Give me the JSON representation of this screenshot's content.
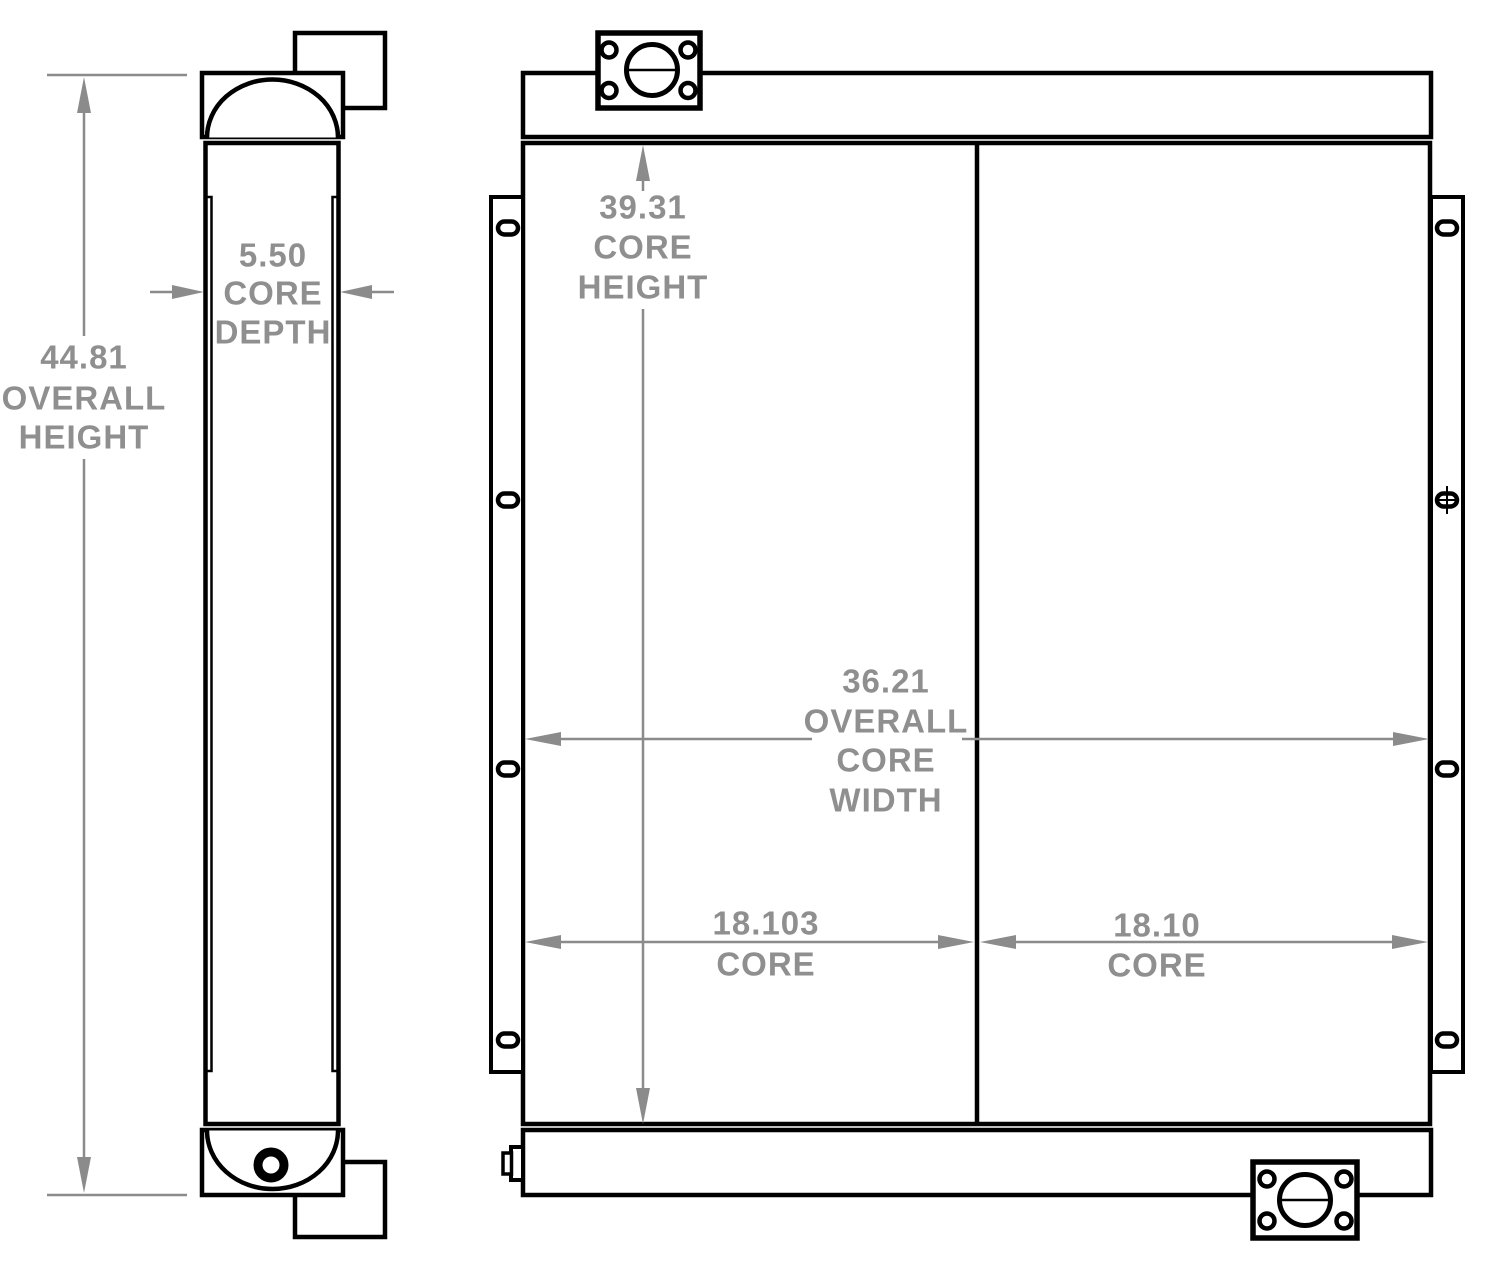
{
  "colors": {
    "background": "#ffffff",
    "outline": "#000000",
    "dimension_line": "#8b8b8b",
    "dimension_text": "#8f8f8f"
  },
  "side_view": {
    "overall_height": {
      "value": "44.81",
      "label_line1": "OVERALL",
      "label_line2": "HEIGHT"
    },
    "core_depth": {
      "value": "5.50",
      "label_line1": "CORE",
      "label_line2": "DEPTH"
    }
  },
  "front_view": {
    "core_height": {
      "value": "39.31",
      "label_line1": "CORE",
      "label_line2": "HEIGHT"
    },
    "overall_core_width": {
      "value": "36.21",
      "label_line1": "OVERALL",
      "label_line2": "CORE",
      "label_line3": "WIDTH"
    },
    "core_width_left": {
      "value": "18.103",
      "label_line1": "CORE"
    },
    "core_width_right": {
      "value": "18.10",
      "label_line1": "CORE"
    }
  }
}
